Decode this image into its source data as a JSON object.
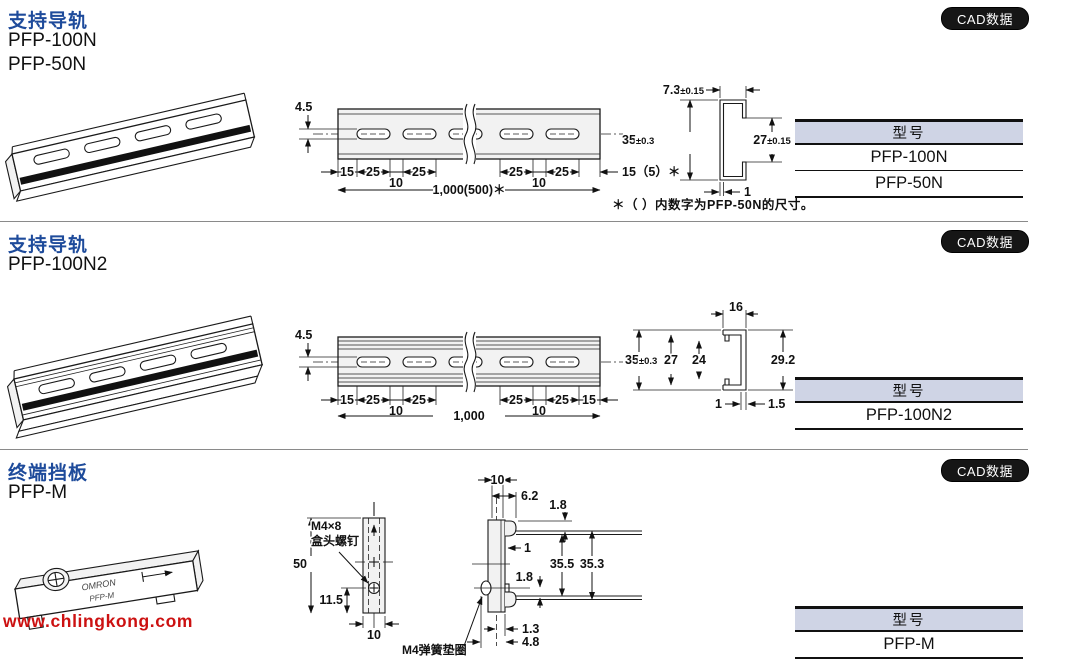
{
  "ui": {
    "cad_button_label": "CAD数据",
    "table_header": "型号",
    "watermark": "www.chlingkong.com",
    "colors": {
      "title_blue": "#1e4b9b",
      "table_header_bg": "#cfd4e5",
      "button_black": "#161616",
      "watermark_red": "#cc1111",
      "line_color": "#1a1a1a"
    }
  },
  "sections": [
    {
      "title": "支持导轨",
      "model_line1": "PFP-100N",
      "model_line2": "PFP-50N",
      "note": "＊（ ）内数字为PFP-50N的尺寸。",
      "table_rows": [
        "PFP-100N",
        "PFP-50N"
      ],
      "dims": {
        "slot_w": "4.5",
        "s1": "15",
        "s2": "25",
        "s3": "10",
        "s4": "25",
        "s5": "25",
        "s6": "10",
        "s7": "25",
        "end": "15（5）＊",
        "total": "1,000(500)＊",
        "prof_w": "7.3",
        "prof_w_tol": "±0.15",
        "prof_h": "35",
        "prof_h_tol": "±0.3",
        "prof_inner": "27",
        "prof_inner_tol": "±0.15",
        "prof_t": "1"
      }
    },
    {
      "title": "支持导轨",
      "model_line1": "PFP-100N2",
      "table_rows": [
        "PFP-100N2"
      ],
      "dims": {
        "slot_w": "4.5",
        "s1": "15",
        "s2": "25",
        "s3": "10",
        "s4": "25",
        "s5": "25",
        "s6": "10",
        "s7": "25",
        "end": "15",
        "total": "1,000",
        "top_w": "16",
        "h": "35",
        "h_tol": "±0.3",
        "h27": "27",
        "h24": "24",
        "h_right": "29.2",
        "t1": "1",
        "t15": "1.5"
      }
    },
    {
      "title": "终端挡板",
      "model_line1": "PFP-M",
      "table_rows": [
        "PFP-M"
      ],
      "dims": {
        "screw1": "M4×8",
        "screw2": "盒头螺钉",
        "h50": "50",
        "h115": "11.5",
        "w10": "10",
        "s10": "10",
        "s62": "6.2",
        "s18a": "1.8",
        "s1": "1",
        "s355": "35.5",
        "s353": "35.3",
        "s18b": "1.8",
        "s13": "1.3",
        "s48": "4.8",
        "washer": "M4弹簧垫圈",
        "brand": "OMRON",
        "engraving": "PFP-M"
      }
    }
  ]
}
